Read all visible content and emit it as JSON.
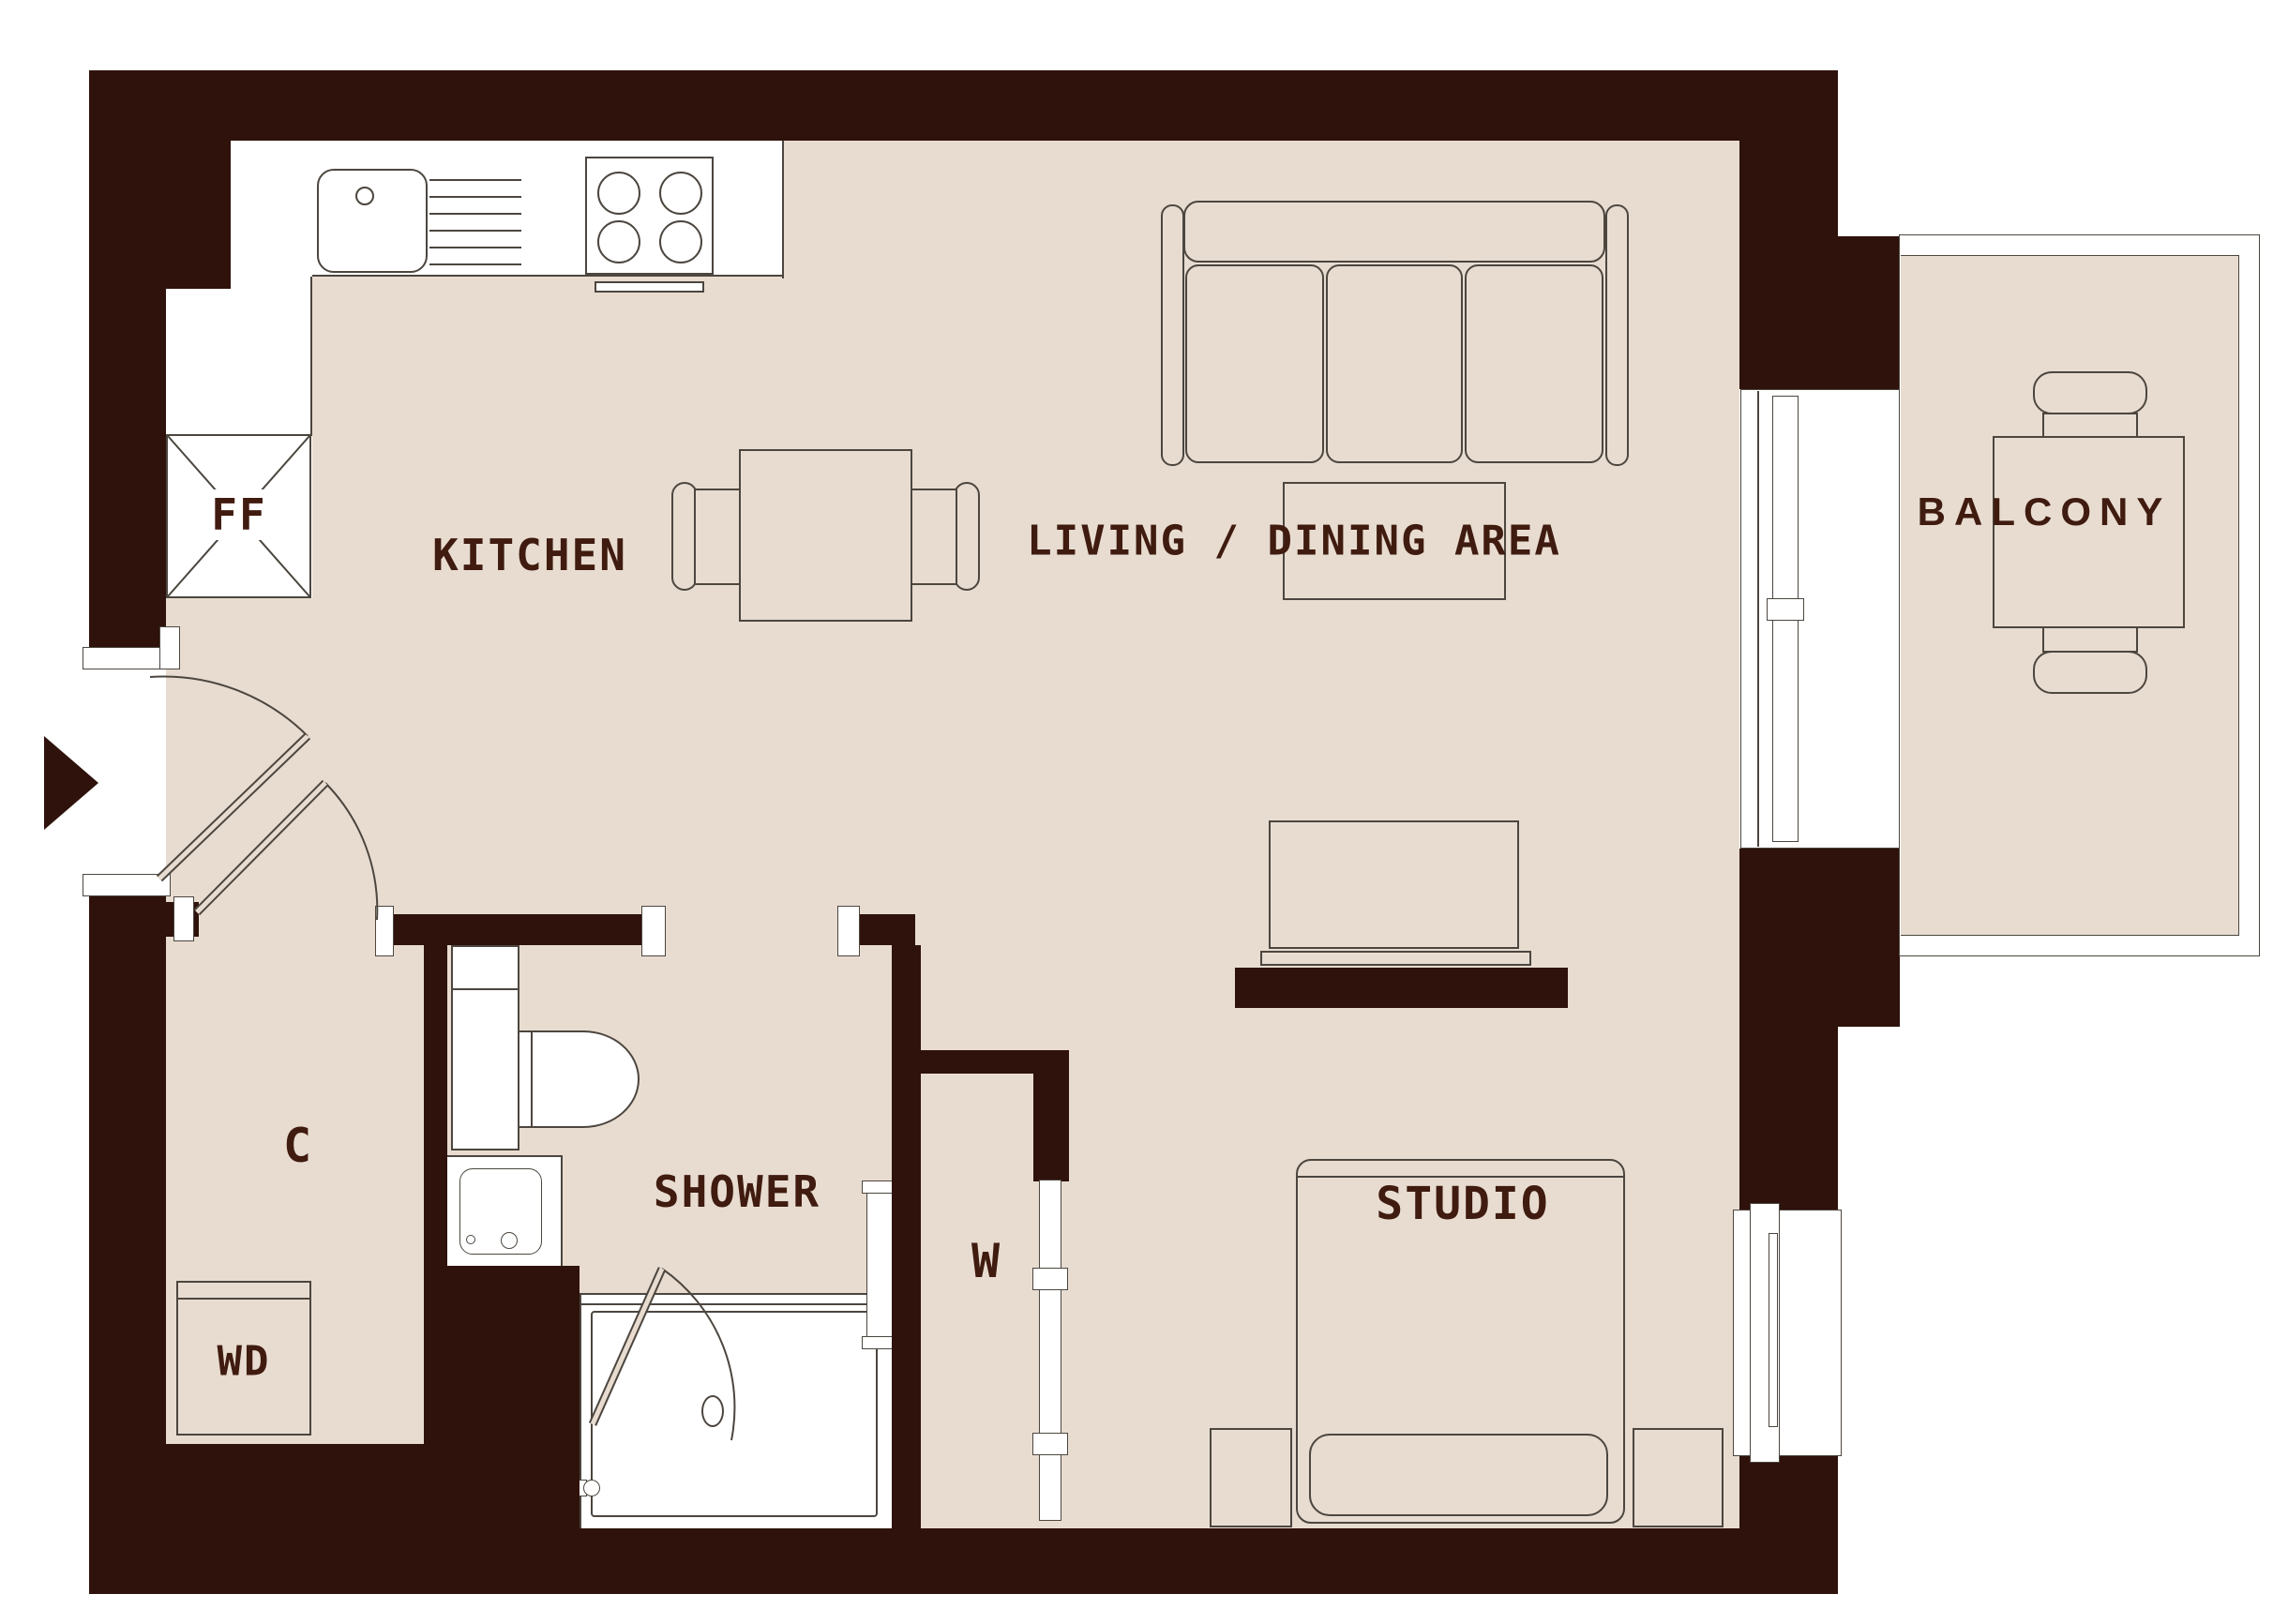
{
  "title": "Studio apartment floor plan",
  "colors": {
    "wall": "#2e120b",
    "floor": "#e8dcd0",
    "outline": "#4c463f",
    "label_text": "#401b0f",
    "background": "#ffffff"
  },
  "labels": {
    "kitchen": "KITCHEN",
    "living_dining": "LIVING / DINING AREA",
    "balcony": "BALCONY",
    "shower": "SHOWER",
    "studio": "STUDIO",
    "closet": "C",
    "wardrobe": "W",
    "washer_dryer": "WD",
    "fridge_freezer": "FF"
  },
  "rooms": [
    {
      "id": "kitchen",
      "label": "KITCHEN"
    },
    {
      "id": "living_dining",
      "label": "LIVING / DINING AREA"
    },
    {
      "id": "balcony",
      "label": "BALCONY"
    },
    {
      "id": "shower",
      "label": "SHOWER"
    },
    {
      "id": "studio",
      "label": "STUDIO"
    },
    {
      "id": "closet_c",
      "label": "C"
    },
    {
      "id": "wardrobe_w",
      "label": "W"
    },
    {
      "id": "washer_dryer_wd",
      "label": "WD"
    },
    {
      "id": "fridge_freezer_ff",
      "label": "FF"
    }
  ]
}
